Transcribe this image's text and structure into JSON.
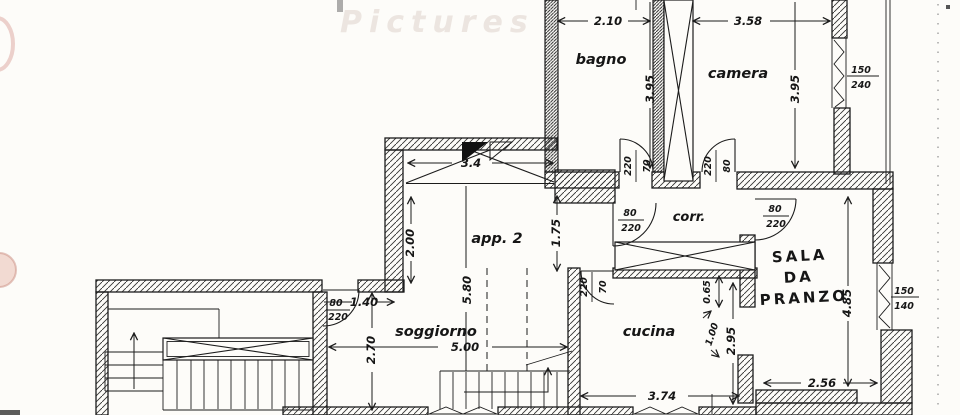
{
  "watermark": "Pictures",
  "colors": {
    "paper": "#fdfcf9",
    "ink": "#1c1c1c",
    "artifact_pink": "#e9bdb2"
  },
  "labels": {
    "bagno": "bagno",
    "camera": "camera",
    "app2": "app. 2",
    "corr": "corr.",
    "soggiorno": "soggiorno",
    "cucina": "cucina",
    "sala1": "SALA",
    "sala2": "DA",
    "sala3": "PRANZO"
  },
  "dims": {
    "bagno_w": "2.10",
    "camera_w": "3.58",
    "bagno_h": "3.95",
    "camera_h": "3.95",
    "app2_w": "3.4",
    "app2_left": "2.00",
    "app2_h": "5.80",
    "app2_right": "1.75",
    "sogg_h": "2.70",
    "sogg_w": "5.00",
    "entry_w": "1.40",
    "cucina_w": "3.74",
    "cucina_h": "2.95",
    "pass_off": "0.65",
    "pass_w": "1.00",
    "sala_w": "2.56",
    "sala_h": "4.85"
  },
  "doors": {
    "bagno_w": "70",
    "bagno_h": "220",
    "camera_w": "80",
    "camera_h": "220",
    "corr_left_w": "80",
    "corr_left_h": "220",
    "corr_right_w": "80",
    "corr_right_h": "220",
    "cucina_w": "70",
    "cucina_h": "220",
    "entrance_w": "80",
    "entrance_h": "220"
  },
  "windows": {
    "camera_w": "150",
    "camera_h": "240",
    "sala_w": "150",
    "sala_h": "140"
  }
}
